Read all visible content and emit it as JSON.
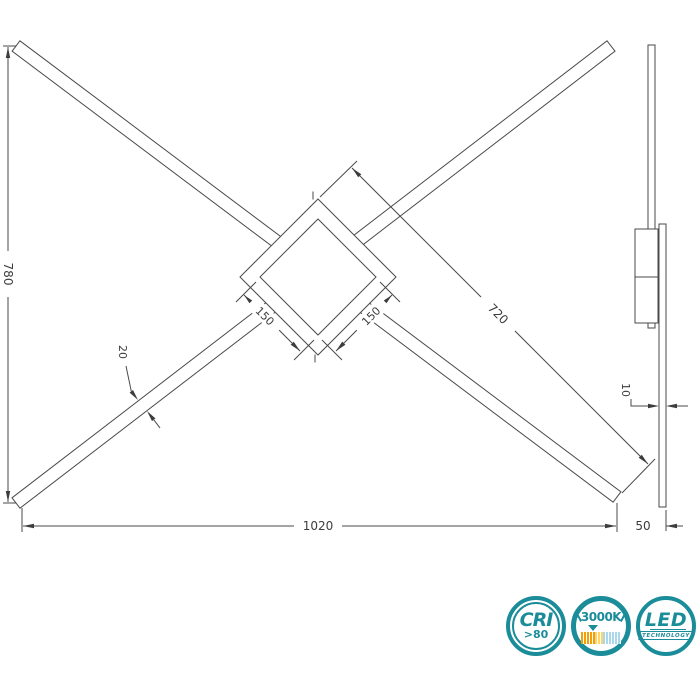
{
  "drawing": {
    "labels": {
      "total_height": "780",
      "total_width": "1020",
      "arm_length": "720",
      "center_square_left": "150",
      "center_square_right": "150",
      "bar_width": "20",
      "profile_thickness": "10",
      "side_depth": "50"
    }
  },
  "badges": {
    "accent_color": "#1b8c99",
    "cri": {
      "title": "CRI",
      "value": ">80"
    },
    "color_temperature": {
      "value": "3000K",
      "scale_warm_color": "#f2a007",
      "scale_mid_color": "#ffd469",
      "scale_cool_color": "#a9d8ea"
    },
    "led": {
      "title": "LED",
      "subtitle": "TECHNOLOGY"
    }
  }
}
